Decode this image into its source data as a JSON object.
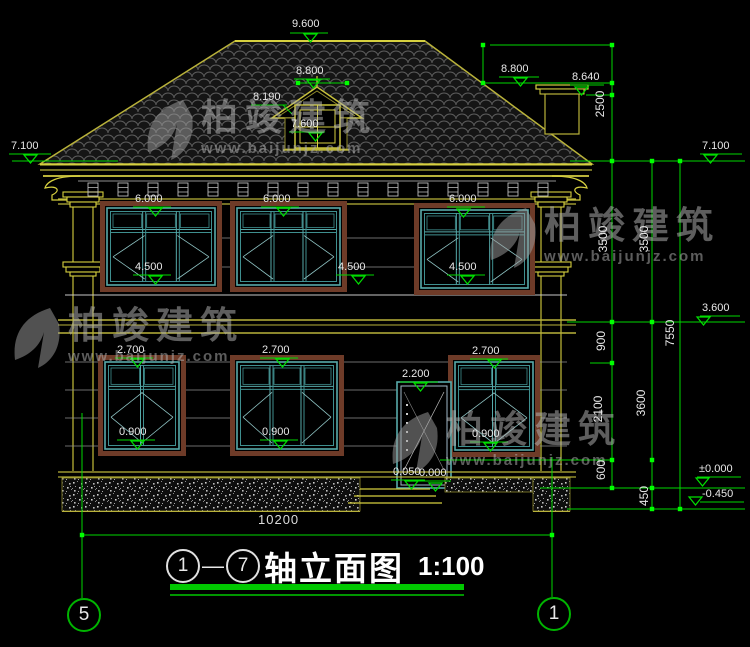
{
  "title": {
    "axis_start": "1",
    "separator": "—",
    "axis_end": "7",
    "name": "轴立面图",
    "scale": "1:100"
  },
  "axis_markers": {
    "bottom_left": "5",
    "bottom_right": "1"
  },
  "watermark": {
    "brand": "柏竣建筑",
    "url": "www.baijunjz.com"
  },
  "overall_dimension": "10200",
  "colors": {
    "background": "#000000",
    "cad_yellow": "#b9b23a",
    "cad_bright_yellow": "#d6d03f",
    "dimension_green": "#00d800",
    "tick_green": "#00ff00",
    "annotation_white": "#e8e8e8",
    "window_teal": "#57aaaa",
    "window_frame_brown": "#6e3b28",
    "watermark_gray": "#b4b4b4"
  },
  "elevation_annotations": [
    {
      "name": "elev-ridge",
      "text": "9.600",
      "x": 292,
      "y": 18,
      "ul": [
        290,
        33,
        38
      ],
      "tri": [
        304,
        34
      ]
    },
    {
      "name": "elev-dormer-peak",
      "text": "8.800",
      "x": 296,
      "y": 65,
      "ul": [
        294,
        79,
        36
      ],
      "tri": [
        307,
        80
      ]
    },
    {
      "name": "elev-dormer-eave",
      "text": "8.190",
      "x": 253,
      "y": 91,
      "ul": [
        251,
        105,
        36
      ],
      "leader": [
        283,
        105,
        292,
        114
      ]
    },
    {
      "name": "elev-dormer-sill",
      "text": "7.600",
      "x": 291,
      "y": 118,
      "ul": [
        289,
        132,
        36
      ],
      "tri": [
        309,
        133
      ]
    },
    {
      "name": "elev-roof-right",
      "text": "8.800",
      "x": 501,
      "y": 63,
      "ul": [
        499,
        77,
        40
      ],
      "tri": [
        514,
        78
      ]
    },
    {
      "name": "elev-chimney",
      "text": "8.640",
      "x": 572,
      "y": 71,
      "ul": [
        570,
        85,
        34
      ],
      "tri": [
        575,
        87
      ]
    },
    {
      "name": "elev-eave-left",
      "text": "7.100",
      "x": 11,
      "y": 140,
      "ul": [
        9,
        154,
        42
      ],
      "tri": [
        24,
        155
      ]
    },
    {
      "name": "elev-eave-right",
      "text": "7.100",
      "x": 702,
      "y": 140,
      "ul": [
        700,
        154,
        42
      ],
      "tri": [
        704,
        155
      ]
    },
    {
      "name": "elev-f2-head-1",
      "text": "6.000",
      "x": 135,
      "y": 193,
      "ul": [
        133,
        207,
        38
      ],
      "tri": [
        149,
        208
      ]
    },
    {
      "name": "elev-f2-head-2",
      "text": "6.000",
      "x": 263,
      "y": 193,
      "ul": [
        261,
        207,
        38
      ],
      "tri": [
        277,
        208
      ]
    },
    {
      "name": "elev-f2-head-3",
      "text": "6.000",
      "x": 449,
      "y": 193,
      "ul": [
        447,
        207,
        38
      ],
      "tri": [
        457,
        209
      ]
    },
    {
      "name": "elev-f2-sill-1",
      "text": "4.500",
      "x": 135,
      "y": 261,
      "ul": [
        133,
        275,
        38
      ],
      "tri": [
        149,
        276
      ]
    },
    {
      "name": "elev-f2-sill-2",
      "text": "4.500",
      "x": 338,
      "y": 261,
      "ul": [
        336,
        275,
        38
      ],
      "tri": [
        352,
        276
      ]
    },
    {
      "name": "elev-f2-sill-3",
      "text": "4.500",
      "x": 449,
      "y": 261,
      "ul": [
        447,
        275,
        38
      ],
      "tri": [
        461,
        276
      ]
    },
    {
      "name": "elev-f1-head-1",
      "text": "2.700",
      "x": 117,
      "y": 344,
      "ul": [
        115,
        358,
        38
      ],
      "tri": [
        131,
        359
      ]
    },
    {
      "name": "elev-f1-head-2",
      "text": "2.700",
      "x": 262,
      "y": 344,
      "ul": [
        260,
        358,
        38
      ],
      "tri": [
        276,
        359
      ]
    },
    {
      "name": "elev-f1-head-3",
      "text": "2.700",
      "x": 472,
      "y": 345,
      "ul": [
        470,
        359,
        38
      ],
      "tri": [
        488,
        360
      ]
    },
    {
      "name": "elev-door-head",
      "text": "2.200",
      "x": 402,
      "y": 368,
      "ul": [
        400,
        382,
        38
      ],
      "tri": [
        414,
        383
      ]
    },
    {
      "name": "elev-f1-sill-1",
      "text": "0.900",
      "x": 119,
      "y": 426,
      "ul": [
        117,
        440,
        38
      ],
      "tri": [
        131,
        441
      ]
    },
    {
      "name": "elev-f1-sill-2",
      "text": "0.900",
      "x": 262,
      "y": 426,
      "ul": [
        260,
        440,
        38
      ],
      "tri": [
        274,
        441
      ]
    },
    {
      "name": "elev-f1-sill-3",
      "text": "0.900",
      "x": 472,
      "y": 428,
      "ul": [
        470,
        442,
        38
      ],
      "tri": [
        484,
        443
      ]
    },
    {
      "name": "elev-door-sill-a",
      "text": "0.050",
      "x": 393,
      "y": 466,
      "ul": [
        391,
        480,
        34
      ],
      "tri": [
        405,
        481
      ]
    },
    {
      "name": "elev-door-sill-b",
      "text": "0.000",
      "x": 419,
      "y": 467,
      "ul": [
        417,
        481,
        34
      ],
      "tri": [
        429,
        483
      ]
    },
    {
      "name": "elev-level-3600",
      "text": "3.600",
      "x": 702,
      "y": 302,
      "ul": [
        700,
        316,
        40
      ],
      "tri": [
        697,
        317
      ]
    },
    {
      "name": "elev-level-zero",
      "text": "±0.000",
      "x": 699,
      "y": 463,
      "ul": [
        697,
        477,
        44
      ],
      "tri": [
        696,
        478
      ]
    },
    {
      "name": "elev-level-neg",
      "text": "-0.450",
      "x": 702,
      "y": 488,
      "ul": [
        700,
        502,
        44
      ],
      "tri": [
        689,
        497
      ]
    }
  ],
  "chain_dimensions": [
    {
      "name": "dim-2500",
      "text": "2500",
      "cx": 600,
      "cy": 105
    },
    {
      "name": "dim-3500-a",
      "text": "3500",
      "cx": 603,
      "cy": 240
    },
    {
      "name": "dim-900",
      "text": "900",
      "cx": 601,
      "cy": 342
    },
    {
      "name": "dim-2100",
      "text": "2100",
      "cx": 598,
      "cy": 410
    },
    {
      "name": "dim-600",
      "text": "600",
      "cx": 601,
      "cy": 471
    },
    {
      "name": "dim-3500-b",
      "text": "3500",
      "cx": 644,
      "cy": 240
    },
    {
      "name": "dim-3600",
      "text": "3600",
      "cx": 641,
      "cy": 404
    },
    {
      "name": "dim-450",
      "text": "450",
      "cx": 644,
      "cy": 497
    },
    {
      "name": "dim-7550",
      "text": "7550",
      "cx": 670,
      "cy": 334
    }
  ]
}
